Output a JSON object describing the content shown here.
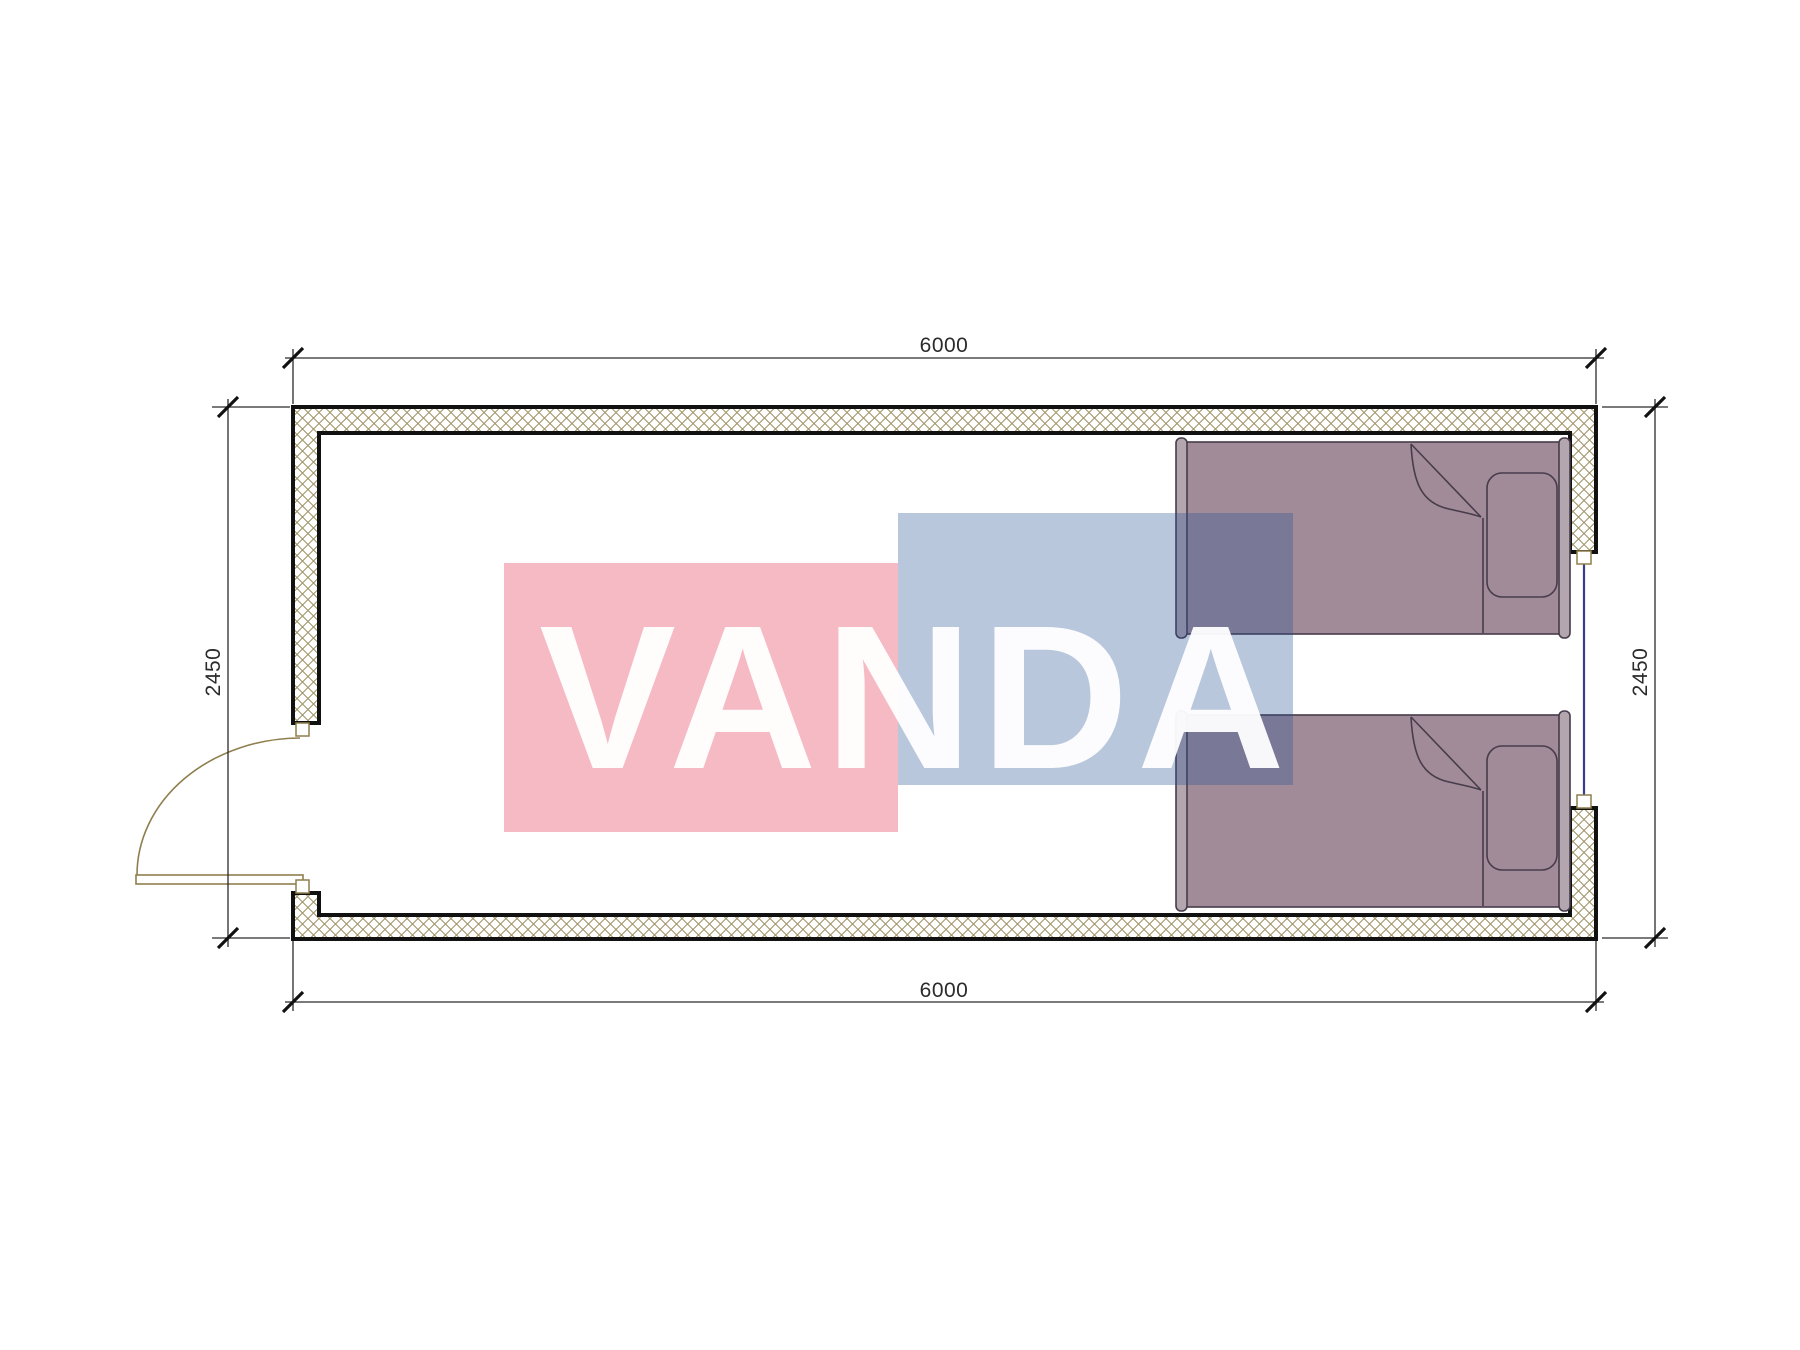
{
  "plan": {
    "dimensions": {
      "top": "6000",
      "bottom": "6000",
      "left": "2450",
      "right": "2450"
    },
    "watermark": {
      "text": "VANDA",
      "pink_fill": "rgba(227,39,74,0.32)",
      "blue_fill": "rgba(37,81,150,0.32)",
      "text_fill": "rgba(255,255,255,0.95)"
    },
    "colors": {
      "wall_line": "#111111",
      "hatch": "#a1956a",
      "bed_fill": "#a28b98",
      "bed_trim": "#b4a6ae",
      "bed_stroke": "#473c4b",
      "door": "#8f7f4e",
      "window_glass": "#3a3a90",
      "dim": "#2b2b2b"
    }
  }
}
